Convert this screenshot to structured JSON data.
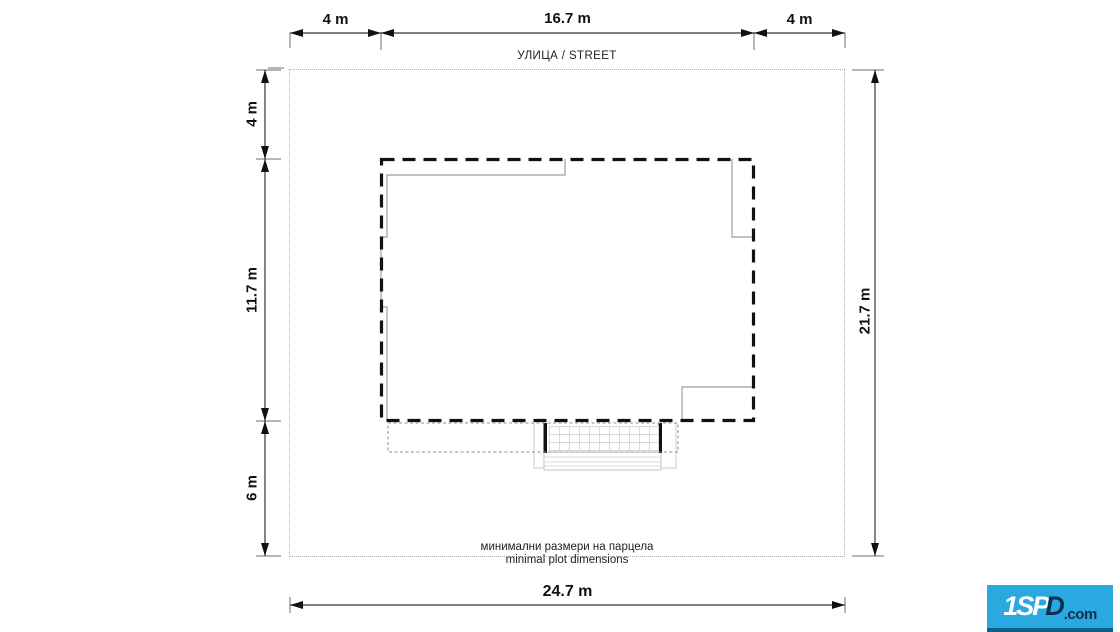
{
  "drawing": {
    "street_label": "УЛИЦА / STREET",
    "caption": {
      "line1": "минимални размери на парцела",
      "line2": "minimal plot dimensions"
    }
  },
  "dimensions": {
    "top_segments": [
      {
        "label": "4 m",
        "meters": 4
      },
      {
        "label": "16.7 m",
        "meters": 16.7
      },
      {
        "label": "4 m",
        "meters": 4
      }
    ],
    "left_segments": [
      {
        "label": "4 m",
        "meters": 4
      },
      {
        "label": "11.7 m",
        "meters": 11.7
      },
      {
        "label": "6 m",
        "meters": 6
      }
    ],
    "right_total": {
      "label": "21.7 m",
      "meters": 21.7
    },
    "bottom_total": {
      "label": "24.7 m",
      "meters": 24.7
    }
  },
  "logo": {
    "part1": "1SP",
    "part2": "D",
    "suffix": ".com",
    "bg_color": "#2aa8e0",
    "dark_color": "#0e3050"
  },
  "colors": {
    "building_outline": "#111111",
    "plot_boundary": "#b0b0b0",
    "inner_walls": "#9c9c9c",
    "dimension_lines": "#333333"
  }
}
